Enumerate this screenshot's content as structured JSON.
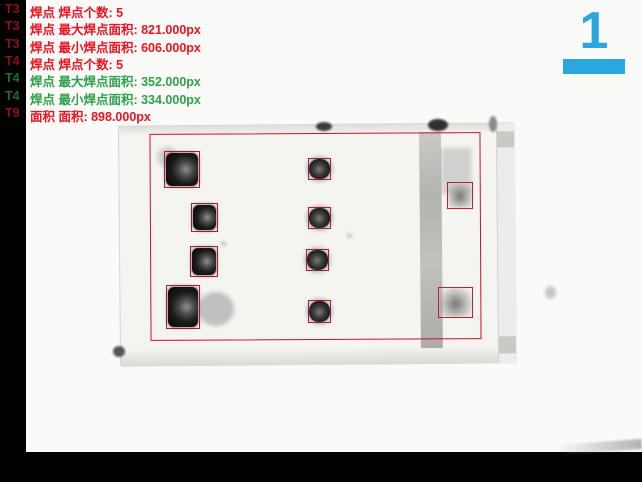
{
  "window": {
    "background": "#000000",
    "type": "vision-inspection-result-view"
  },
  "image_view": {
    "background": "#fafaf8",
    "content": "grayscale camera image of connector with solder joints"
  },
  "indicator": {
    "value": "1",
    "color": "#2ba7e0"
  },
  "colors": {
    "fail_text_red": "#ee1220",
    "fail_tag_dark_red": "#8c1212",
    "pass_text_green": "#2ea14b",
    "pass_tag_dark_green": "#1e6e2e",
    "detection_box_red": "#c41626",
    "indicator_cyan": "#2ba7e0"
  },
  "measurements": [
    {
      "tag": "T3",
      "text": "焊点 焊点个数: 5",
      "metric": "焊点个数",
      "value": "5",
      "status": "ng"
    },
    {
      "tag": "T3",
      "text": "焊点 最大焊点面积: 821.000px",
      "metric": "最大焊点面积",
      "value": "821.000px",
      "status": "ng"
    },
    {
      "tag": "T3",
      "text": "焊点 最小焊点面积: 606.000px",
      "metric": "最小焊点面积",
      "value": "606.000px",
      "status": "ng"
    },
    {
      "tag": "T4",
      "text": "焊点 焊点个数: 5",
      "metric": "焊点个数",
      "value": "5",
      "status": "ng"
    },
    {
      "tag": "T4",
      "text": "焊点 最大焊点面积: 352.000px",
      "metric": "最大焊点面积",
      "value": "352.000px",
      "status": "ok"
    },
    {
      "tag": "T4",
      "text": "焊点 最小焊点面积: 334.000px",
      "metric": "最小焊点面积",
      "value": "334.000px",
      "status": "ok"
    },
    {
      "tag": "T9",
      "text": "面积 面积: 898.000px",
      "metric": "面积",
      "value": "898.000px",
      "status": "ng"
    }
  ],
  "detections": {
    "roi": {
      "x": 150,
      "y": 133,
      "w": 331,
      "h": 207
    },
    "boxes": [
      {
        "id": "t3-1",
        "x": 164,
        "y": 151,
        "w": 36,
        "h": 37,
        "style": "dark-large"
      },
      {
        "id": "t3-2",
        "x": 191,
        "y": 203,
        "w": 27,
        "h": 29,
        "style": "dark-large"
      },
      {
        "id": "t3-3",
        "x": 190,
        "y": 246,
        "w": 28,
        "h": 31,
        "style": "dark-large"
      },
      {
        "id": "t3-4",
        "x": 166,
        "y": 285,
        "w": 34,
        "h": 44,
        "style": "dark-large"
      },
      {
        "id": "t4-1",
        "x": 308,
        "y": 158,
        "w": 23,
        "h": 22,
        "style": "dark-small"
      },
      {
        "id": "t4-2",
        "x": 308,
        "y": 207,
        "w": 23,
        "h": 22,
        "style": "dark-small"
      },
      {
        "id": "t4-3",
        "x": 306,
        "y": 249,
        "w": 23,
        "h": 22,
        "style": "dark-small"
      },
      {
        "id": "t4-4",
        "x": 308,
        "y": 300,
        "w": 23,
        "h": 23,
        "style": "dark-small"
      },
      {
        "id": "t9-1",
        "x": 447,
        "y": 182,
        "w": 26,
        "h": 27,
        "style": "smudge"
      },
      {
        "id": "t9-2",
        "x": 438,
        "y": 287,
        "w": 35,
        "h": 31,
        "style": "smudge"
      }
    ]
  }
}
